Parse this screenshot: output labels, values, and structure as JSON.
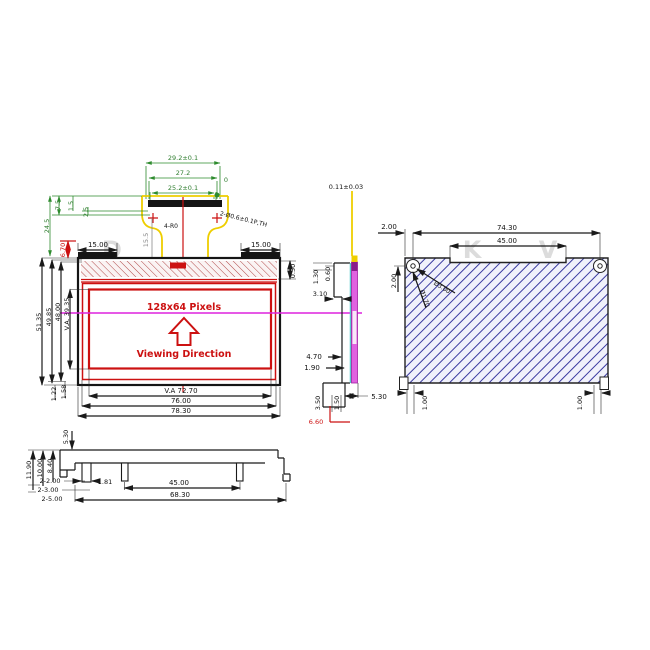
{
  "title": "128x64 OLED display module dimensional drawing",
  "connector": {
    "dim_a": "29.2±0.1",
    "dim_b": "27.2",
    "dim_c": "25.2±0.1",
    "datum": "0",
    "radius_note": "4-R0",
    "hole_note": "2-Ø0.6±0.1P,TH",
    "d245": "24.5",
    "d75": "7.5",
    "d15": "1.5",
    "d25": "2.5",
    "d155": "15.5",
    "d670": "6.70"
  },
  "front": {
    "pixels": "128x64 Pixels",
    "viewing": "Viewing Direction",
    "top_left": "15.00",
    "top_right": "15.00",
    "gap": "0.50",
    "h1": "51.35",
    "h2": "49.85",
    "h3": "48.00",
    "va_h": "V.A. 39.35",
    "g1": "1.22",
    "g2": "1.58",
    "va_w": "V.A 72.70",
    "w2": "76.00",
    "w1": "78.30"
  },
  "side": {
    "film": "0.11±0.03",
    "a": "1.30",
    "b": "0.60",
    "c": "3.10",
    "d": "4.70",
    "e": "1.90",
    "f": "5.30",
    "g": "3.50",
    "h": "1.50",
    "i": "6.60"
  },
  "back": {
    "w": "74.30",
    "notch": "45.00",
    "off_h": "2.00",
    "off_v": "2.00",
    "hole_outer": "Ø3.00",
    "hole_inner": "Ø1.70",
    "tab_l": "1.00",
    "tab_r": "1.00"
  },
  "bottom": {
    "h": "5.30",
    "d1": "11.90",
    "d2": "10.00",
    "d3": "8.40",
    "p1": "2-2.00",
    "p2": "2-3.00",
    "p3": "2-5.00",
    "pin": "1.81",
    "span": "45.00",
    "total": "68.30"
  },
  "watermark": {
    "a": "D",
    "b": "K",
    "c": "V"
  },
  "colors": {
    "dim_green": "#2e8b2e",
    "accent_red": "#cc1111",
    "centerline_magenta": "#dd22dd",
    "connector_yellow": "#eece00",
    "hatch_blue": "#3a3aa0",
    "glass_magenta": "#e062e0",
    "film_cyan": "#55cccc",
    "line_black": "#1a1a1a"
  }
}
